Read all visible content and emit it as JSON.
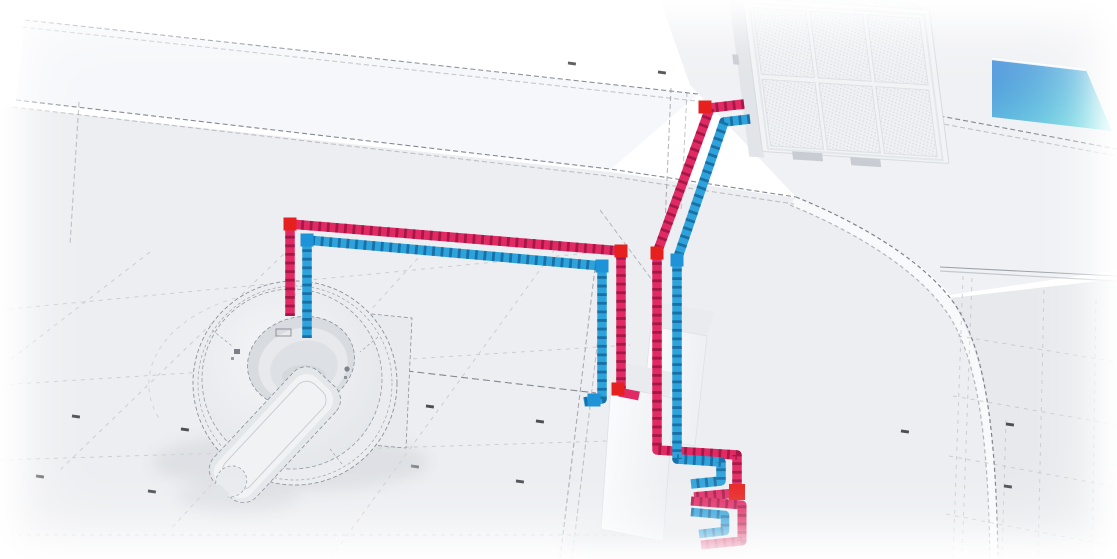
{
  "scene": {
    "type": "isometric-technical-illustration",
    "subject": "ct-scanner-cooling-piping-circuit"
  },
  "colors": {
    "background": "#ffffff",
    "floor_main": "#edeef1",
    "floor_roof": "#f0f1f4",
    "floor_right": "#e7e9ec",
    "wall_band": "#f6f7fa",
    "wall_line": "#70767f",
    "grid_line": "#b3b8bf",
    "marking_line": "#6d737c",
    "curve_line": "#7d838c",
    "curve_band": "#f8f9fb",
    "tick_mark": "#2e3136",
    "shadow": "#d2d5da",
    "scanner_body": "#eaecef",
    "scanner_face": "#eff1f3",
    "scanner_outline": "#8b919b",
    "bore_rim": "#d8dbdf",
    "bore_mid": "#e7e9ec",
    "bore_hole": "#dde0e4",
    "table_base": "#e4e7ea",
    "table_top": "#f0f2f4",
    "cabinet": "#e8eaed",
    "pedestal": "#dde0e5",
    "box_top": "#e9ebee",
    "box_face": "#fafbfd",
    "condenser_body": "#f1f3f5",
    "condenser_frame": "#d7dade",
    "condenser_side": "#e1e4e8",
    "condenser_fan": "#e7eaed",
    "condenser_feet": "#c9cdd3",
    "glass_blue": "#4a90db",
    "glass_cyan": "#7ce6e4",
    "pipe_hot_light": "#e02a64",
    "pipe_hot_dark": "#9d1342",
    "pipe_hot_elbow": "#e6201f",
    "pipe_cold_light": "#2ea2da",
    "pipe_cold_dark": "#15679d",
    "pipe_cold_elbow": "#1f93d8"
  },
  "components": {
    "ct_scanner": {
      "parts": [
        "gantry",
        "bore",
        "patient-table",
        "equipment-cabinet",
        "base-pedestal"
      ]
    },
    "condenser_unit": {
      "mesh_panel_rows": 2,
      "mesh_panel_cols": 3,
      "fans": 3
    },
    "equipment_boxes": {
      "count": 2
    },
    "pipe_circuit": {
      "hot_line_color_name": "red",
      "cold_line_color_name": "blue",
      "coil_loops": 2
    },
    "glass_panel": {
      "name": "blue-glass-wall-panel"
    }
  }
}
